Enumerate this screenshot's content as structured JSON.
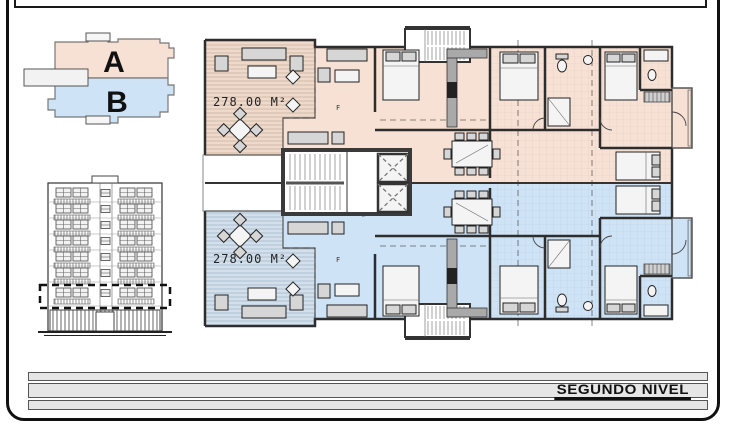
{
  "key_plan": {
    "unit_a": "A",
    "unit_b": "B"
  },
  "apartments": {
    "a_area": "278.00 M²",
    "b_area": "278.00 M²",
    "room_label_a": "F",
    "room_label_b": "F"
  },
  "footer": {
    "level_label": "SEGUNDO NIVEL"
  },
  "colors": {
    "unit-a-room": "#f7e1d4",
    "unit-a-terr": "#eed9cb",
    "unit-b-room": "#cfe3f7",
    "unit-b-terr": "#d3e0ec",
    "wall": "#2d2d2d",
    "bar-bg": "#e6e6e6"
  }
}
